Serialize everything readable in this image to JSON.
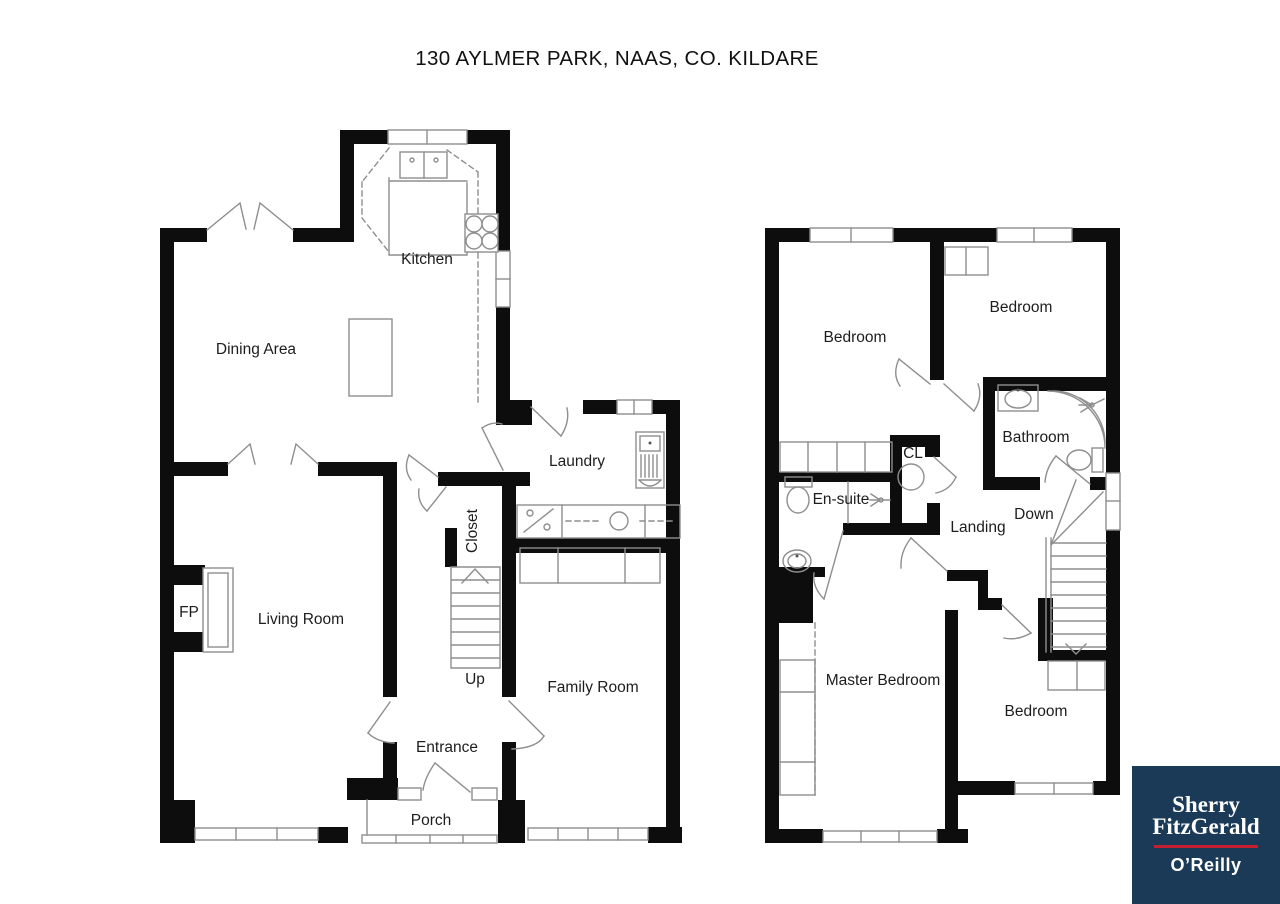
{
  "title": "130 AYLMER PARK, NAAS, CO. KILDARE",
  "ground_floor": {
    "rooms": {
      "kitchen": "Kitchen",
      "dining": "Dining Area",
      "laundry": "Laundry",
      "closet": "Closet",
      "fireplace": "FP",
      "living": "Living Room",
      "stairs": "Up",
      "family": "Family Room",
      "entrance": "Entrance",
      "porch": "Porch"
    }
  },
  "first_floor": {
    "rooms": {
      "bedroom1": "Bedroom",
      "bedroom2": "Bedroom",
      "bathroom": "Bathroom",
      "ensuite": "En-suite",
      "closet": "CL",
      "landing": "Landing",
      "stairs": "Down",
      "master": "Master Bedroom",
      "bedroom3": "Bedroom"
    }
  },
  "logo": {
    "line1": "Sherry",
    "line2": "FitzGerald",
    "office": "O’Reilly",
    "bg_color": "#1a3a57",
    "rule_color": "#c41f30"
  }
}
